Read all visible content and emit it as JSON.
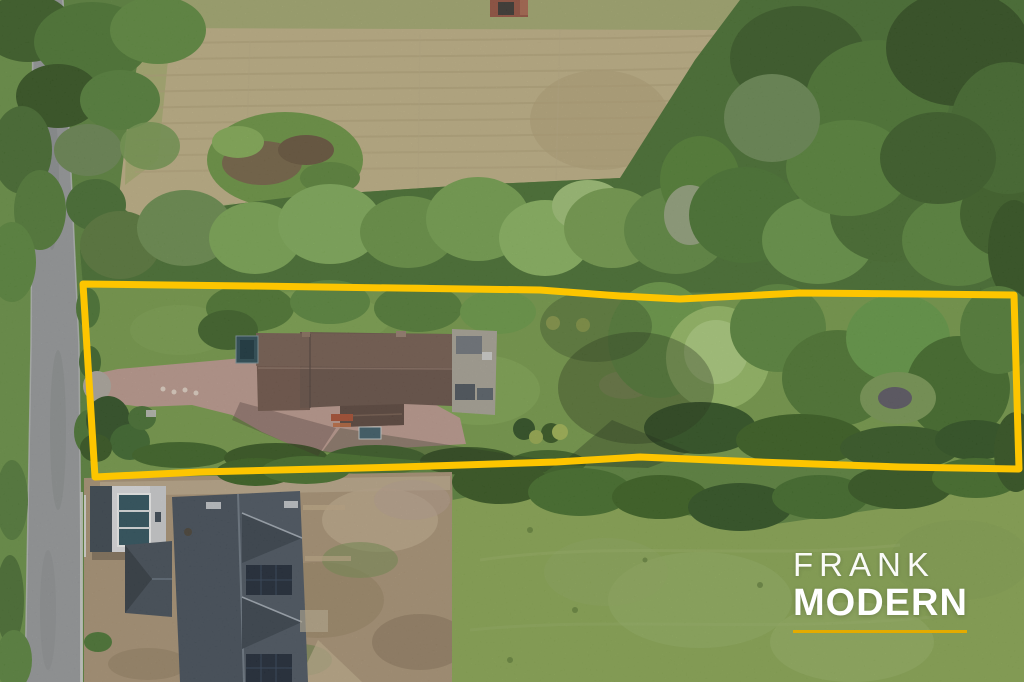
{
  "watermark": {
    "line1": "FRANK",
    "line2": "MODERN",
    "text_color": "#ffffff",
    "underline_color": "#e4ab00"
  },
  "boundary": {
    "color": "#fdc500",
    "stroke_width": "7",
    "description": "Irregular yellow outline marking the long narrow plot for sale"
  },
  "scene": {
    "type": "aerial-drone-photo",
    "elements": [
      {
        "name": "country-road",
        "position": "left edge, running top to bottom"
      },
      {
        "name": "mown-field",
        "position": "top, pale straw colour with mowing lines"
      },
      {
        "name": "brick-ruin",
        "position": "top centre edge of field"
      },
      {
        "name": "tree-belt",
        "position": "between field and plot, dense in top-right corner"
      },
      {
        "name": "plot-lawn",
        "position": "inside boundary, left half"
      },
      {
        "name": "brick-driveway",
        "position": "from road entrance to house"
      },
      {
        "name": "main-house-brown-roof",
        "position": "inside boundary, left of centre"
      },
      {
        "name": "garden-trees",
        "position": "inside boundary, right half with light willow"
      },
      {
        "name": "garden-clearing-pond",
        "position": "inside boundary, far right"
      },
      {
        "name": "new-build-house-slate-roof",
        "position": "bottom left, with solar panels"
      },
      {
        "name": "white-garage",
        "position": "bottom left beside road"
      },
      {
        "name": "construction-dirt",
        "position": "bottom left around new build"
      },
      {
        "name": "meadow-lawn",
        "position": "bottom right"
      }
    ]
  }
}
